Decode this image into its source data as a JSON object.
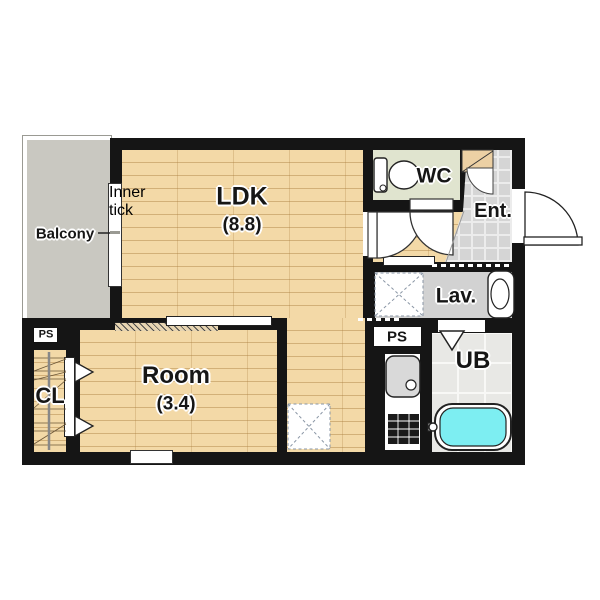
{
  "type": "apartment-floor-plan",
  "rooms": {
    "balcony": {
      "label": "Balcony"
    },
    "ldk": {
      "label": "LDK",
      "area": "(8.8)"
    },
    "room": {
      "label": "Room",
      "area": "(3.4)"
    },
    "wc": {
      "label": "WC"
    },
    "entrance": {
      "label": "Ent."
    },
    "lavatory": {
      "label": "Lav."
    },
    "unit_bath": {
      "label": "UB"
    },
    "closet": {
      "label": "CL"
    },
    "pipe_shaft_left": {
      "label": "PS"
    },
    "pipe_shaft_right": {
      "label": "PS"
    }
  },
  "icons": {
    "toilet-icon": "toilet with tank",
    "bathtub-icon": "bathtub with water",
    "kitchen-sink-icon": "kitchen sink with faucet",
    "stove-icon": "gas stove",
    "vanity-icon": "wash basin",
    "washer-space-icon": "dashed box with X (washing machine space)",
    "fridge-space-icon": "dashed box with X (refrigerator space)",
    "door-swing-icon": "quarter-circle door swing",
    "folding-door-icon": "triangle folding door"
  },
  "colors": {
    "wall": "#151515",
    "wood_floor": "#f3d9a7",
    "balcony_floor": "#c9c8c1",
    "wc_floor": "#e0e4cf",
    "entrance_tile": "#d5d5d5",
    "lavatory_floor": "#d2d2d2",
    "unit_bath_floor": "#e8e8e5",
    "tub_water": "#7deef2"
  }
}
